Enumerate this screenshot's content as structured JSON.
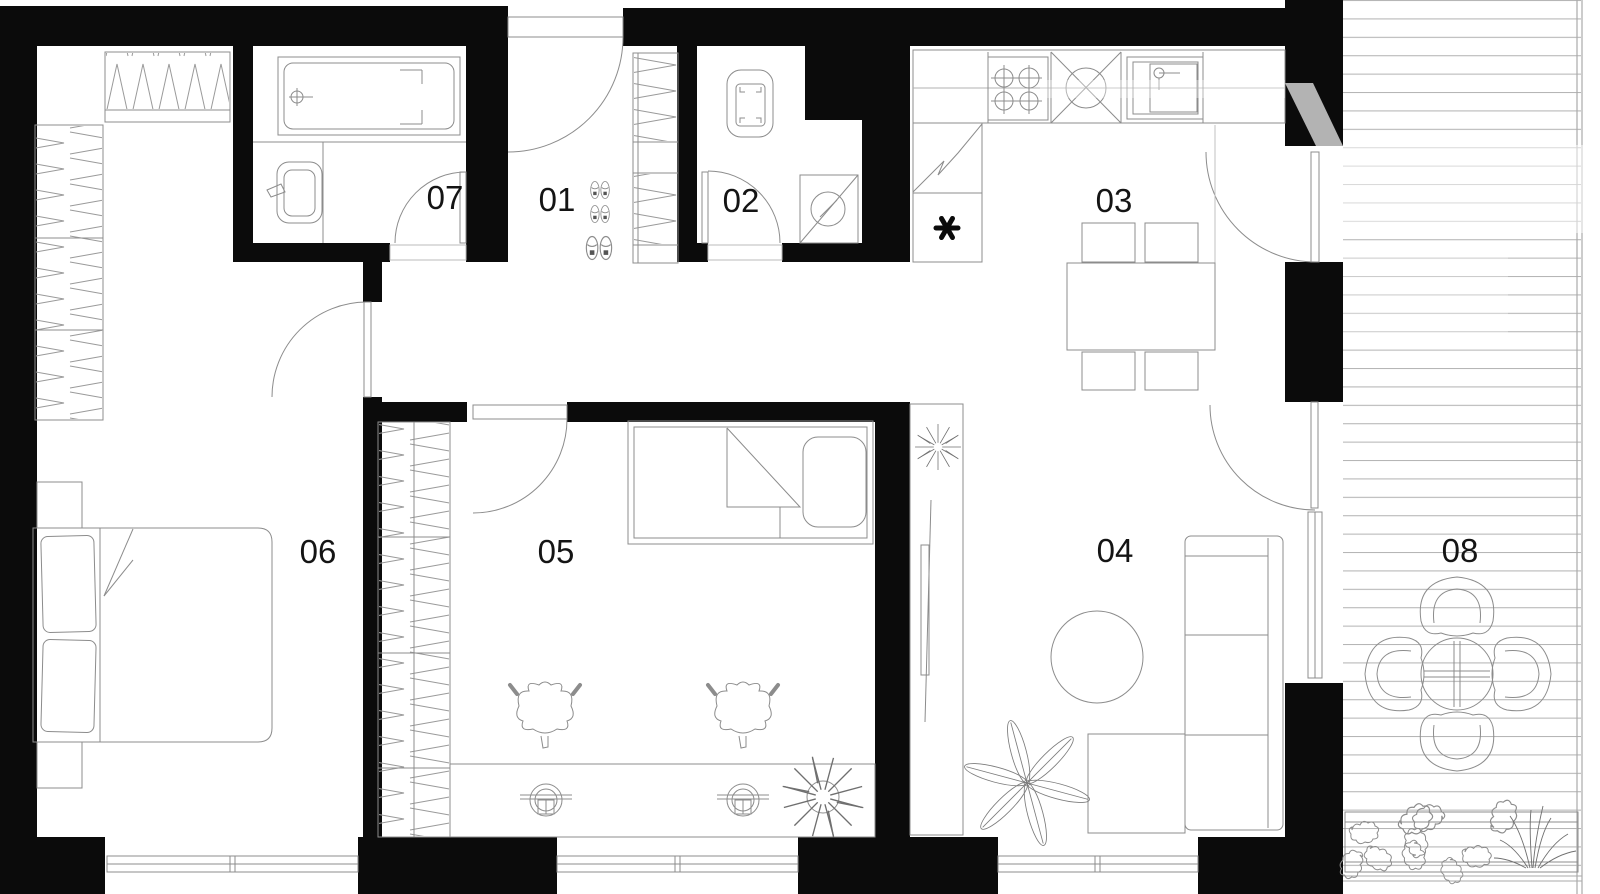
{
  "plan": {
    "type": "apartment-floor-plan",
    "rooms": [
      {
        "id": "room-01",
        "label": "01"
      },
      {
        "id": "room-02",
        "label": "02"
      },
      {
        "id": "room-03",
        "label": "03"
      },
      {
        "id": "room-04",
        "label": "04"
      },
      {
        "id": "room-05",
        "label": "05"
      },
      {
        "id": "room-06",
        "label": "06"
      },
      {
        "id": "room-07",
        "label": "07"
      },
      {
        "id": "room-08",
        "label": "08"
      }
    ],
    "symbols": [
      "entrance-door-icon",
      "door-swing-icon",
      "bathtub-icon",
      "washbasin-icon",
      "toilet-icon",
      "washing-machine-icon",
      "stove-icon",
      "kitchen-sink-icon",
      "fridge-asterisk-icon",
      "dining-table-icon",
      "sofa-icon",
      "coffee-table-icon",
      "tv-icon",
      "double-bed-icon",
      "single-bed-icon",
      "desk-icon",
      "desk-chair-icon",
      "wardrobe-icon",
      "shoes-icon",
      "plant-icon",
      "terrace-table-icon",
      "terrace-chair-icon",
      "planter-icon",
      "deck-boards",
      "window-icon"
    ],
    "fridge_symbol": "✱",
    "colors": {
      "background": "#ffffff",
      "wall": "#0b0b0b",
      "furniture_line": "#8c8c8c",
      "deck_line": "#b5b5b5",
      "shaft_gray": "#b3b3b3",
      "label": "#141414"
    }
  }
}
